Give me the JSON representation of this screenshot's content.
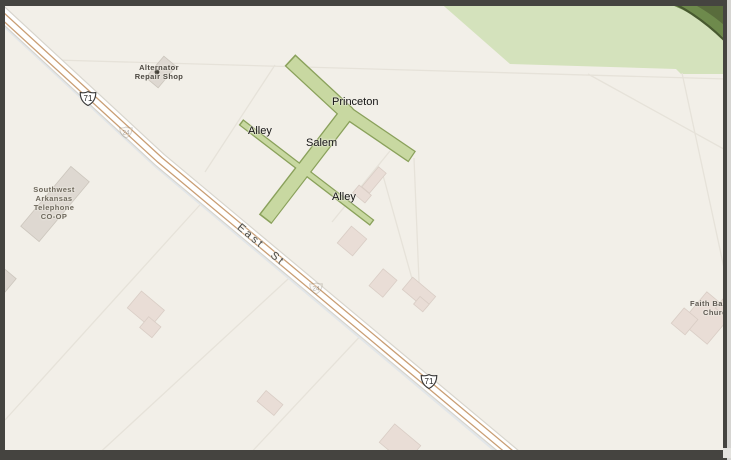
{
  "map": {
    "street_labels": {
      "princeton": "Princeton",
      "salem": "Salem",
      "alley_upper": "Alley",
      "alley_lower": "Alley",
      "east_st": "East St"
    },
    "shields": [
      {
        "number": "71"
      },
      {
        "number": "24"
      },
      {
        "number": "24"
      },
      {
        "number": "71"
      }
    ],
    "poi": {
      "alternator": {
        "line1": "Alternator",
        "line2": "Repair Shop"
      },
      "telephone": {
        "line1": "Southwest",
        "line2": "Arkansas",
        "line3": "Telephone",
        "line4": "CO-OP"
      },
      "church": {
        "line1": "Faith Ba",
        "line2": "Churc"
      }
    },
    "colors": {
      "background": "#f2efe8",
      "forest": "#d4e2bc",
      "forest_band": "#6d8a4b",
      "street_highlight_fill": "#c8d8a1",
      "street_highlight_border": "#8aa15b",
      "road_fill": "#ffffff",
      "road_lines": "#c99e74",
      "building_fill": "#e9ddd6",
      "parcel_line": "#e6e2d9"
    }
  }
}
